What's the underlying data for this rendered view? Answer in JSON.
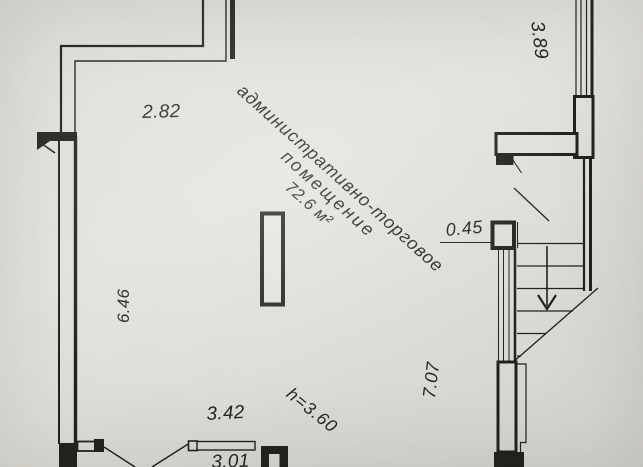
{
  "room": {
    "label_line1": "административно-торговое",
    "label_line2": "помещение",
    "area": "72.6 м²",
    "height": "h=3.60"
  },
  "dimensions": {
    "top_wall": "2.82",
    "left_wall": "6.46",
    "top_right_window": "3.89",
    "right_wall": "7.07",
    "pillar": "0.45",
    "bottom_opening": "3.42",
    "bottom_clipped": "3.01",
    "top_edge_clipped": "5."
  },
  "icons": {
    "stairs_direction": "down-arrow"
  },
  "colors": {
    "paper": "#e6e4df",
    "ink": "#211f1c"
  }
}
